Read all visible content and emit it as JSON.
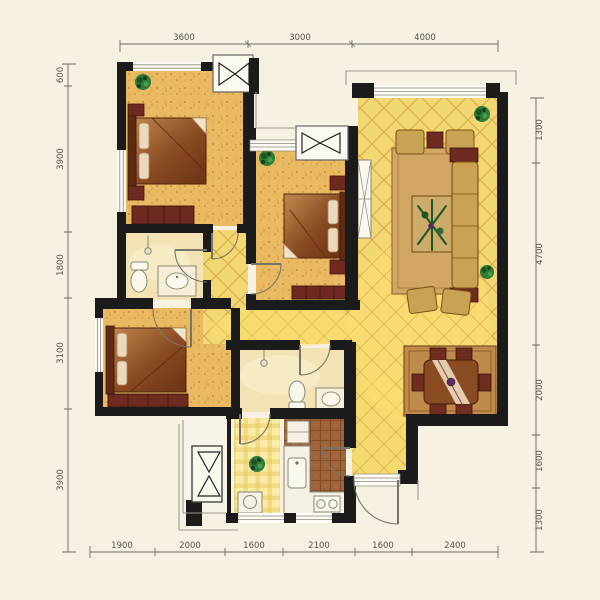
{
  "canvas": {
    "width": 600,
    "height": 600,
    "background": "#f6f1e0"
  },
  "dimensions": {
    "top": [
      "3600",
      "3000",
      "4000"
    ],
    "bottom": [
      "1900",
      "2000",
      "1600",
      "2100",
      "1600",
      "2400"
    ],
    "left": [
      "600",
      "3900",
      "1800",
      "3100",
      "3900"
    ],
    "right": [
      "1300",
      "4700",
      "2000",
      "1600",
      "1300"
    ]
  },
  "palette": {
    "wall": "#1b1b1b",
    "bedroom_floor": "#e9ba62",
    "tile_floor": "#f3d772",
    "tile_line": "#d3a94c",
    "bath_floor": "#f2e2b4",
    "kitchen_floor": "#a0643a",
    "balcony_check": "#f8eca6",
    "rug": "#d2a766",
    "wood": "#8a4a22",
    "furniture_tan": "#c9a253",
    "maroon": "#6e2a20",
    "plant": "#2e7d32",
    "dim_line": "#6b6b60",
    "outline": "#9a9a8c"
  },
  "icons": {
    "ac_unit": "bowtie-symbol",
    "plant": "foliage-cluster",
    "door": "quarter-arc-swing",
    "window": "triple-line-band"
  }
}
